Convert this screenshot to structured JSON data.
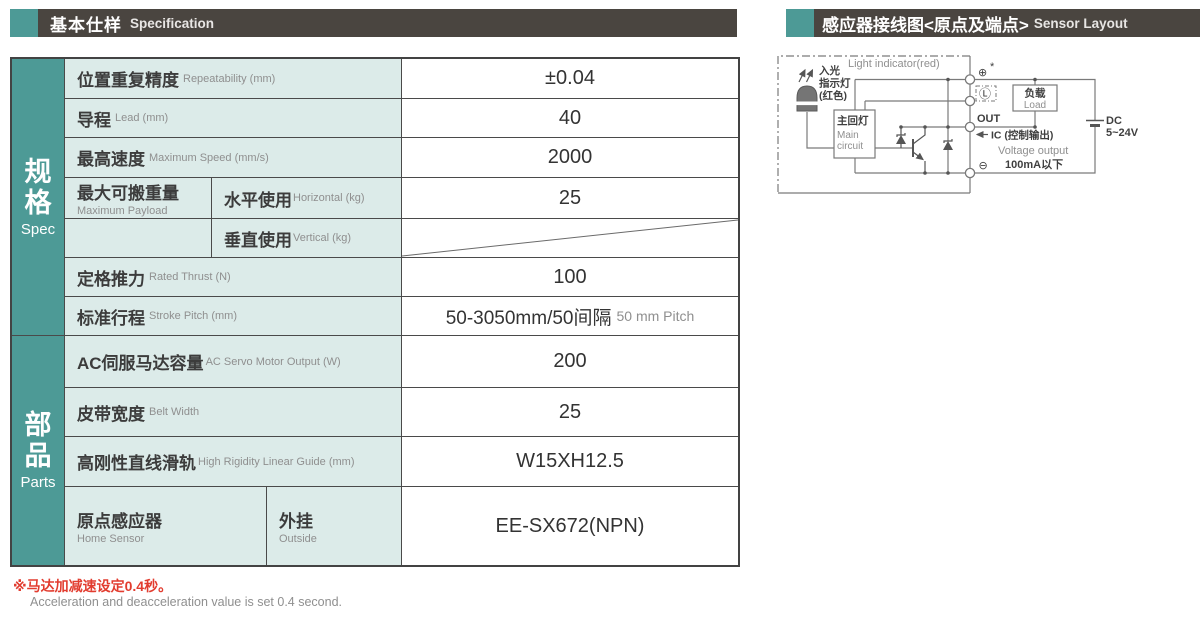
{
  "header_left": {
    "zh": "基本仕样",
    "en": "Specification"
  },
  "header_right": {
    "zh": "感应器接线图<原点及端点>",
    "en": "Sensor Layout"
  },
  "colors": {
    "accent_teal": "#4d9a96",
    "header_bar": "#4a4540",
    "cell_mint": "#dcebe9",
    "footnote_red": "#e23c2f",
    "border": "#4a4a4a",
    "gray_text": "#8f8f8f",
    "dark_text": "#3c3c3c"
  },
  "table": {
    "group_spec": {
      "zh1": "规",
      "zh2": "格",
      "en": "Spec"
    },
    "group_parts": {
      "zh1": "部",
      "zh2": "品",
      "en": "Parts"
    },
    "r1": {
      "zh": "位置重复精度",
      "en": "Repeatability (mm)",
      "val": "±0.04"
    },
    "r2": {
      "zh": "导程",
      "en": "Lead (mm)",
      "val": "40"
    },
    "r3": {
      "zh": "最高速度",
      "en": "Maximum Speed (mm/s)",
      "val": "2000"
    },
    "r4": {
      "zh": "最大可搬重量",
      "en": "Maximum Payload",
      "sub1": {
        "zh": "水平使用",
        "en": "Horizontal (kg)",
        "val": "25"
      },
      "sub2": {
        "zh": "垂直使用",
        "en": "Vertical (kg)",
        "val": ""
      }
    },
    "r5": {
      "zh": "定格推力",
      "en": "Rated Thrust (N)",
      "val": "100"
    },
    "r6": {
      "zh": "标准行程",
      "en": "Stroke Pitch (mm)",
      "val": "50-3050mm/50间隔",
      "val_en": "50 mm Pitch"
    },
    "r7": {
      "zh": "AC伺服马达容量",
      "en": "AC Servo Motor Output (W)",
      "val": "200"
    },
    "r8": {
      "zh": "皮带宽度",
      "en": "Belt Width",
      "val": "25"
    },
    "r9": {
      "zh": "高刚性直线滑轨",
      "en": "High Rigidity Linear Guide (mm)",
      "val": "W15XH12.5"
    },
    "r10": {
      "zh": "原点感应器",
      "en": "Home Sensor",
      "sub_zh": "外挂",
      "sub_en": "Outside",
      "val": "EE-SX672(NPN)"
    }
  },
  "footnote": {
    "zh": "※马达加减速设定0.4秒。",
    "en": "Acceleration and deacceleration value is set 0.4 second."
  },
  "diagram": {
    "labels": {
      "light_indicator_en": "Light indicator(red)",
      "light_in_1": "入光",
      "light_in_2": "指示灯",
      "light_in_3": "(红色)",
      "main_circuit_zh": "主回灯",
      "main_circuit_en1": "Main",
      "main_circuit_en2": "circuit",
      "load_zh": "负载",
      "load_en": "Load",
      "out": "OUT",
      "ic": "IC (控制输出)",
      "voltage": "Voltage output",
      "current_limit": "100mA以下",
      "dc1": "DC",
      "dc2": "5~24V",
      "term_plus": "⊕",
      "term_star": "*",
      "term_light": "Ⓛ",
      "term_minus": "⊖"
    }
  }
}
